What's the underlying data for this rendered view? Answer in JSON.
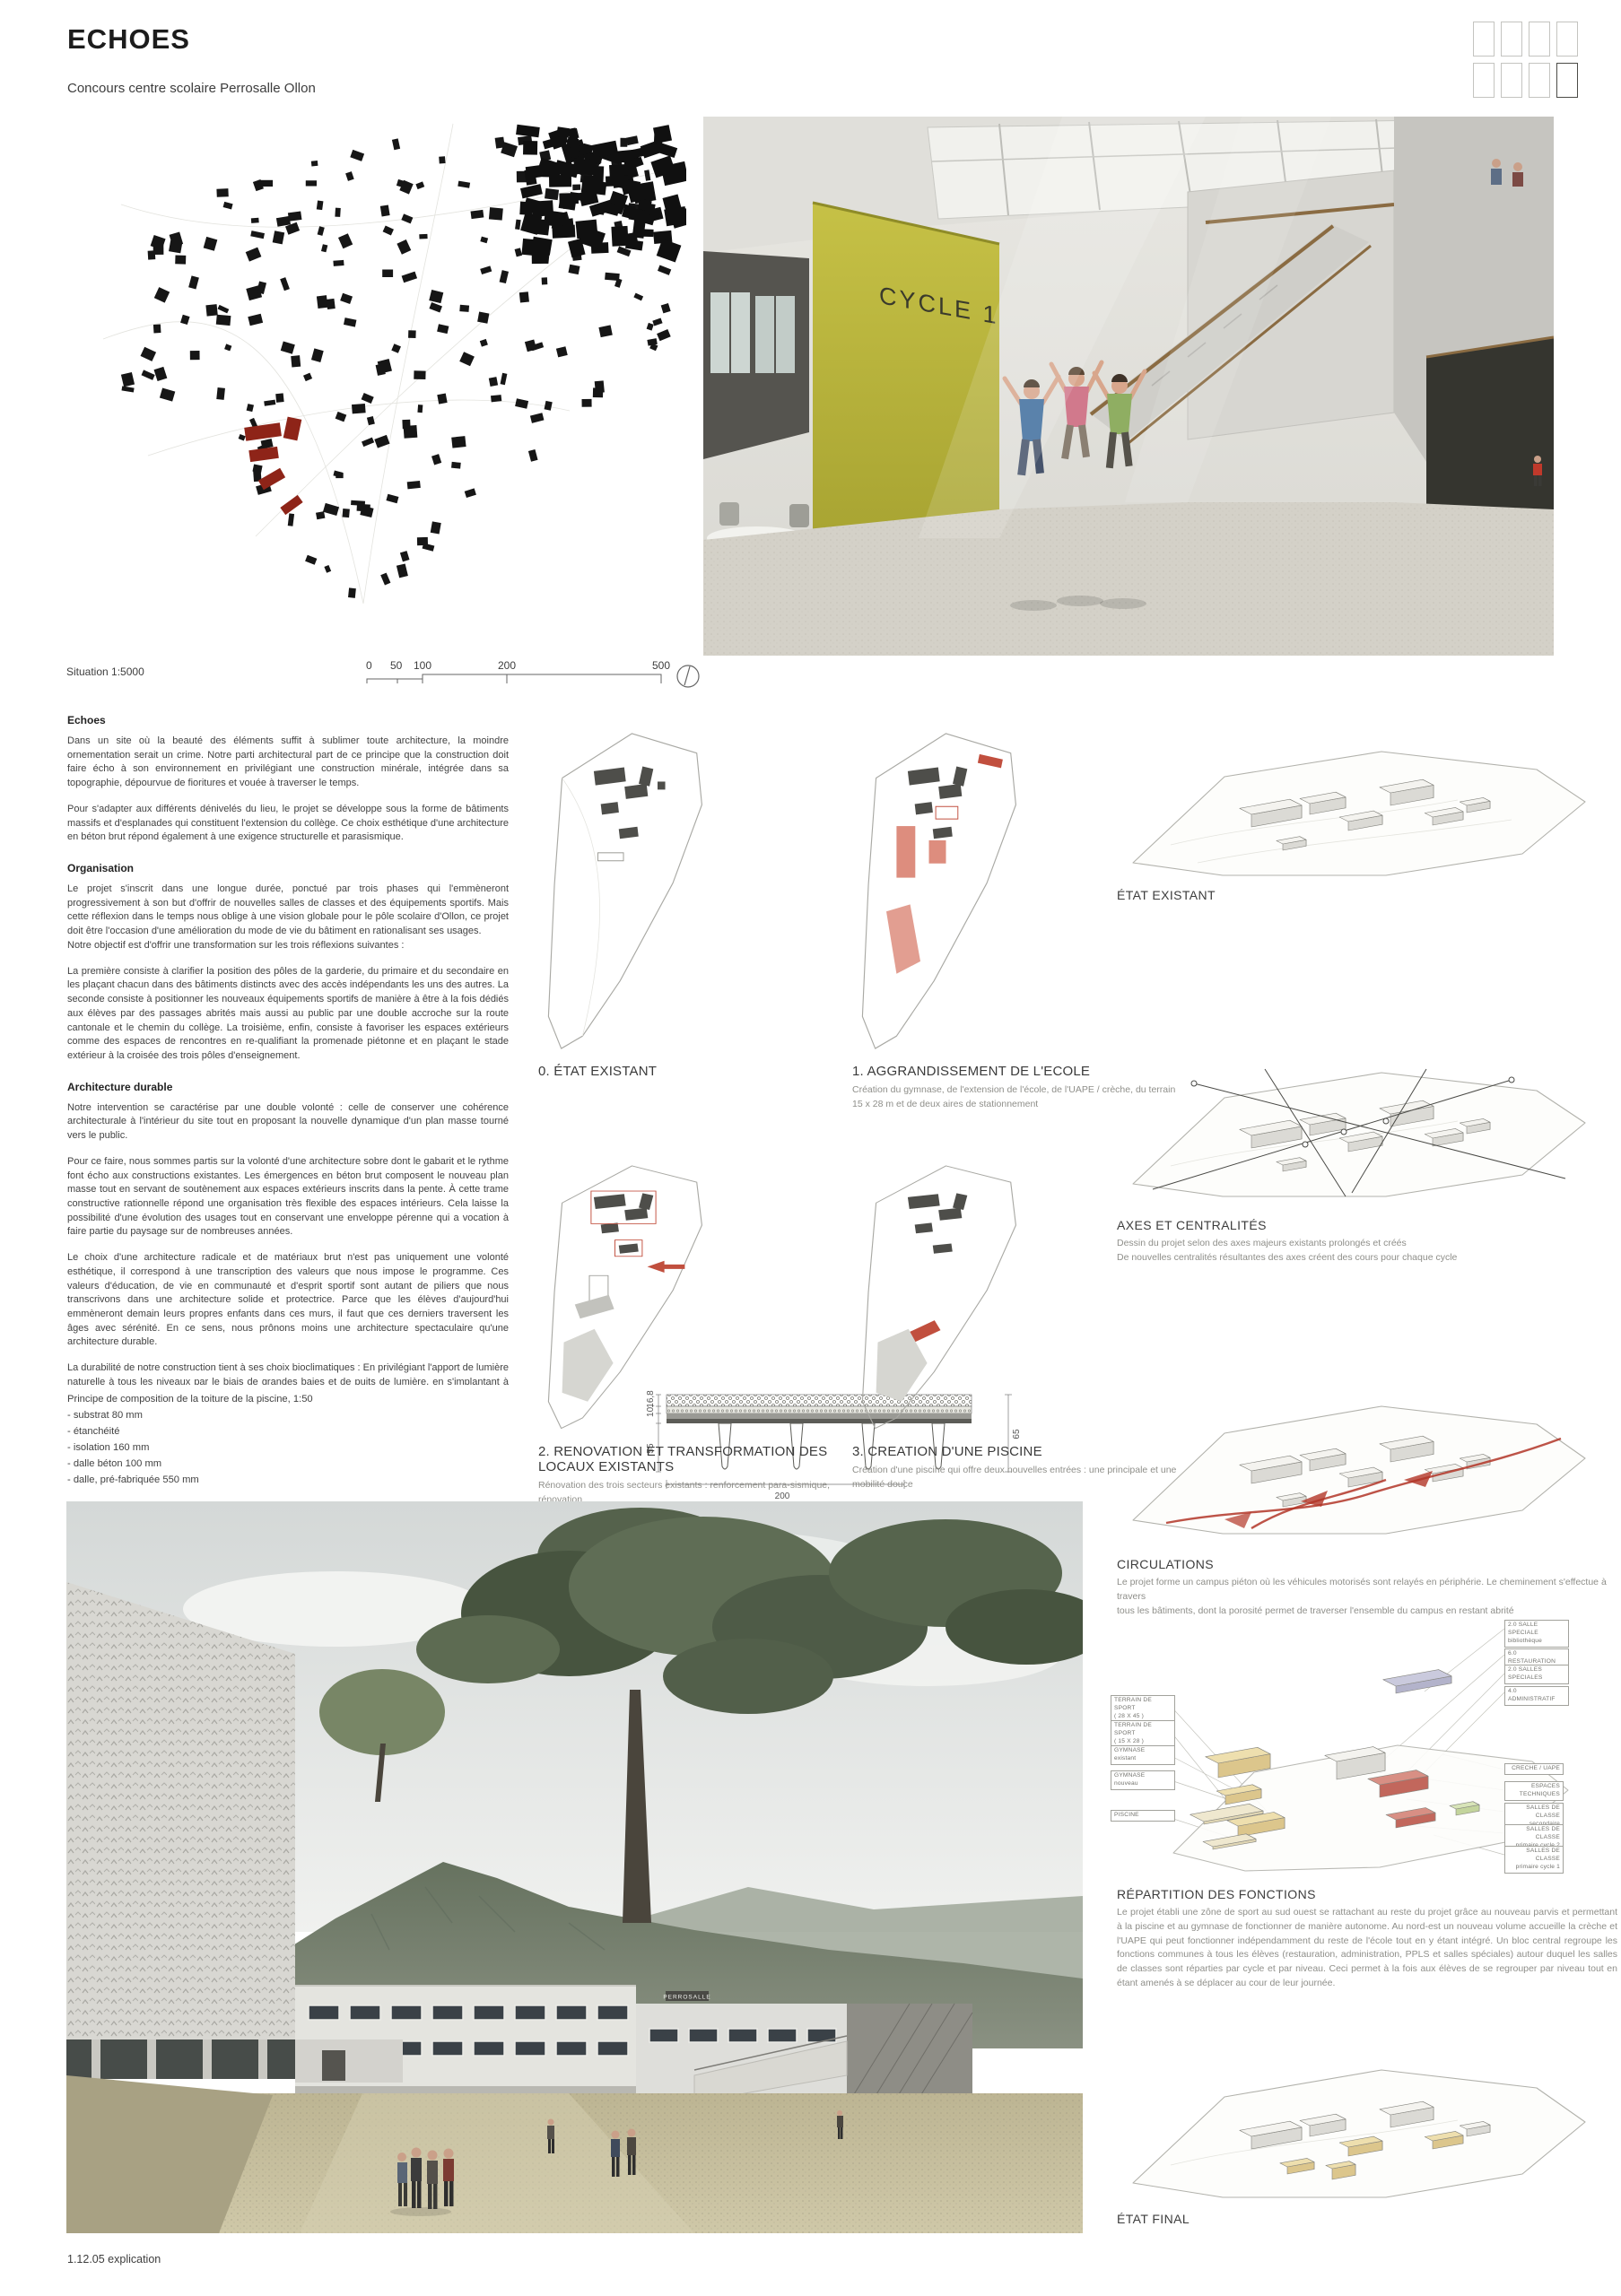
{
  "header": {
    "title": "ECHOES",
    "subtitle": "Concours centre scolaire Perrosalle Ollon"
  },
  "site_plan": {
    "caption": "Situation 1:5000",
    "scale_ticks": [
      "0",
      "50",
      "100",
      "200",
      "500"
    ]
  },
  "render_interior": {
    "wall_label": "CYCLE 1"
  },
  "render_exterior": {
    "sign": "PERROSALLE"
  },
  "sections": [
    {
      "heading": "Echoes",
      "paragraphs": [
        "Dans un site où la beauté des éléments suffit à sublimer toute architecture, la moindre ornementation serait un crime. Notre parti architectural part de ce principe que la construction doit faire écho à son environnement en privilégiant une construction minérale, intégrée dans sa topographie, dépourvue de fioritures et vouée à traverser le temps.",
        "Pour s'adapter aux différents dénivelés du lieu, le projet se développe sous la forme de bâtiments massifs et d'esplanades qui constituent l'extension du collège. Ce choix esthétique d'une architecture en béton brut répond également à une exigence structurelle et parasismique."
      ]
    },
    {
      "heading": "Organisation",
      "paragraphs": [
        "Le projet s'inscrit dans une longue durée, ponctué par trois phases qui l'emmèneront progressivement à son but d'offrir de nouvelles salles de classes et des équipements sportifs. Mais cette réflexion dans le temps nous oblige à une vision globale pour le pôle scolaire d'Ollon, ce projet doit être l'occasion d'une amélioration du mode de vie du bâtiment en rationalisant ses usages.\nNotre objectif est d'offrir une transformation sur les trois réflexions suivantes :",
        "La première consiste à clarifier la position des pôles de la garderie, du primaire et du secondaire en les plaçant chacun dans des bâtiments distincts avec des accès indépendants les uns des autres. La seconde consiste à positionner les nouveaux équipements sportifs de manière à être à la fois dédiés aux élèves par des passages abrités mais aussi au public par une double accroche sur la route cantonale et le chemin du collège. La troisième, enfin, consiste à favoriser les espaces extérieurs comme des espaces de rencontres en re-qualifiant la promenade piétonne et en plaçant le stade extérieur à la croisée des trois pôles d'enseignement."
      ]
    },
    {
      "heading": "Architecture durable",
      "paragraphs": [
        "Notre intervention se caractérise par une double volonté : celle de conserver une cohérence architecturale à l'intérieur du site tout en proposant la nouvelle dynamique d'un plan masse tourné vers le public.",
        "Pour ce faire, nous sommes partis sur la volonté d'une architecture sobre dont le gabarit et le rythme font écho aux constructions existantes. Les émergences en béton brut composent le nouveau plan masse tout en servant de soutènement aux espaces extérieurs inscrits dans la pente. À cette trame constructive rationnelle répond une organisation très flexible des espaces intérieurs. Cela laisse la possibilité d'une évolution des usages tout en conservant une enveloppe pérenne qui a vocation à faire partie du paysage sur de nombreuses années.",
        "Le choix d'une architecture radicale et de matériaux brut n'est pas uniquement une volonté esthétique, il correspond à une transcription des valeurs que nous impose le programme. Ces valeurs d'éducation, de vie en communauté et d'esprit sportif sont autant de piliers que nous transcrivons dans une architecture solide et protectrice. Parce que les élèves d'aujourd'hui emmèneront demain leurs propres enfants dans ces murs, il faut que ces derniers traversent les âges avec sérénité. En ce sens, nous prônons moins une architecture spectaculaire qu'une architecture durable.",
        "La durabilité de notre construction tient à ses choix bioclimatiques : En privilégiant l'apport de lumière naturelle à tous les niveaux par le biais de grandes baies et de puits de lumière, en s'implantant à des altitudes permettant de prévenir tous les risques possibles d'inondations, en gérant l'écoulement et la récupération des eaux de pluies, en misant sur une forte isolation thermique, en privilégiant toutes les économies d'énergies électrique et en faisant le choix d'énergies renouvelables par le biais de panneaux photovoltaïques."
      ]
    },
    {
      "heading": "Structure",
      "paragraphs": [
        "Parce qu'il s'inscrit dans un site d'exception, il mérite un haut niveau d'exigence architecturale et technique.",
        "Le nouveau bâtiment scolaire et celui de la crèche sont composés de structures radier-murs-dalles en béton armé, assurant ainsi la résistance et l'inertie nécessaires aux charges statiques verticales. Les murs des noyaux de circulation verticales sont les refends résistants aux sollicitations sismiques et à celles des vents. De ce fait, les bâtiments sont stables par eux-mêmes.",
        "Le bâtiment dédié au sport est, pour la grande salle double, fait d'une toiture dont la structure est composée de deux sommiers précontraints sur la grande longueur, de part et d'autre de la porte d'entrée. Ces derniers soutiennent des poutres préfabriquées ou métalliques. Pour la petite salle de ce même bâtiment, la structure est faite de poutres préfabriquées ou métalliques sur lesquelles le platelage du toit repose. Le noyau central assure la stabilisation du bâtiment aux sollicitations du vent et à celles du risque sismique.",
        "La structure de la piscine est envisagée en éléments préfabriqués en Π qui portent de façade à façade. La stabilisation est quant à elle assurée par les façades pleines et les murs des vestiaires.",
        "Dans le cadre de la transformation des bâtiments existants, les ingénieurs conservent tous les éléments porteurs du système statique CROCS. L'augmentation de la sécurité aux sollicitations sismiques est assurée par un système inspiré des recommandations du bureau Kurmann & Cretton. Le bâtiment de la crèche, les croix de Saint-André sont disposés à l'intérieur des cloisons et des planchers pour assurer le cheminement des efforts vers l'est du bâtiment où la nouvelle passerelle d'accès permet d'intégrer le renforcement sismique. Les efforts sont ainsi ramenés au niveau du sol de fondation de l'édifice. Le bâtiment A est conçu sur le même principe que la crèche, la passerelle vers le nouveau bâtiment scolaire au sud et la nouvelle sortie de secours à l'est servent d'appui aux sollicitations horizontales."
      ]
    }
  ],
  "roof": {
    "title": "Principe de composition de la toiture de la piscine, 1:50",
    "layers": [
      "- substrat 80 mm",
      "- étanchéité",
      "- isolation 160 mm",
      "- dalle béton 100 mm",
      "- dalle, pré-fabriquée 550 mm"
    ],
    "dim_width": "200",
    "dim_right": "65",
    "dim_left": [
      "55",
      "10,",
      "16,8"
    ]
  },
  "phases": [
    {
      "title": "0. ÉTAT EXISTANT",
      "sub": ""
    },
    {
      "title": "1. AGGRANDISSEMENT DE L'ECOLE",
      "sub": "Création du gymnase, de l'extension de l'école, de l'UAPE / crèche, du terrain\n15 x 28 m et de deux aires de stationnement"
    },
    {
      "title": "2. RENOVATION ET TRANSFORMATION DES LOCAUX EXISTANTS",
      "sub": "Rénovation des trois secteurs existants : renforcement para-sismique, rénovation\ndes façades et réaménagement intérieur. Suppression des bâtiments provisoires.\nCréation d'un terrain de 28 x 45 m"
    },
    {
      "title": "3. CREATION D'UNE PISCINE",
      "sub": "Création d'une piscine qui offre deux nouvelles entrées : une principale et une\nmobilité douce"
    }
  ],
  "right_sections": [
    {
      "label": "ÉTAT EXISTANT",
      "desc": ""
    },
    {
      "label": "AXES ET CENTRALITÉS",
      "desc": "Dessin du projet selon des axes majeurs existants prolongés et créés\nDe nouvelles centralités résultantes des axes créent des cours pour chaque cycle"
    },
    {
      "label": "CIRCULATIONS",
      "desc": "Le projet  forme un campus piéton où les véhicules motorisés sont relayés en périphérie. Le cheminement s'effectue à travers\ntous les bâtiments, dont la porosité permet de traverser l'ensemble du campus en restant abrité"
    },
    {
      "label": "RÉPARTITION DES FONCTIONS",
      "desc": "Le projet établi une zône de sport au sud ouest se rattachant au reste du projet grâce au nouveau parvis et permettant à la piscine et au gymnase de fonctionner de manière autonome. Au nord-est un nouveau volume accueille la crèche et l'UAPE qui peut fonctionner indépendamment du reste de l'école tout en y étant intégré. Un bloc central regroupe les fonctions communes à tous les élèves (restauration, administration, PPLS et salles spéciales) autour duquel les salles de classes sont réparties par cycle et par niveau. Ceci permet à la fois aux élèves de se regrouper par niveau tout en étant amenés à se déplacer au cour de leur journée."
    },
    {
      "label": "ÉTAT FINAL",
      "desc": ""
    }
  ],
  "functions": {
    "left": [
      {
        "l1": "TERRAIN DE SPORT",
        "l2": "( 28 X 45 )"
      },
      {
        "l1": "TERRAIN DE SPORT",
        "l2": "( 15 X 28 )"
      },
      {
        "l1": "GYMNASE",
        "l2": "existant"
      },
      {
        "l1": "GYMNASE",
        "l2": "nouveau"
      },
      {
        "l1": "PISCINE",
        "l2": ""
      }
    ],
    "right": [
      {
        "l1": "2.0 SALLE SPECIALE",
        "l2": "bibliothèque"
      },
      {
        "l1": "6.0 RESTAURATION",
        "l2": ""
      },
      {
        "l1": "2.0 SALLES",
        "l2": "SPECIALES"
      },
      {
        "l1": "4.0 ADMINISTRATIF",
        "l2": ""
      },
      {
        "l1": "CRECHE / UAPE",
        "l2": ""
      },
      {
        "l1": "ESPACES",
        "l2": "TECHNIQUES"
      },
      {
        "l1": "SALLES DE CLASSE",
        "l2": "secondaire"
      },
      {
        "l1": "SALLES DE CLASSE",
        "l2": "primaire cycle 2"
      },
      {
        "l1": "SALLES DE CLASSE",
        "l2": "primaire cycle 1"
      }
    ]
  },
  "footer": {
    "note": "1.12.05 explication"
  }
}
